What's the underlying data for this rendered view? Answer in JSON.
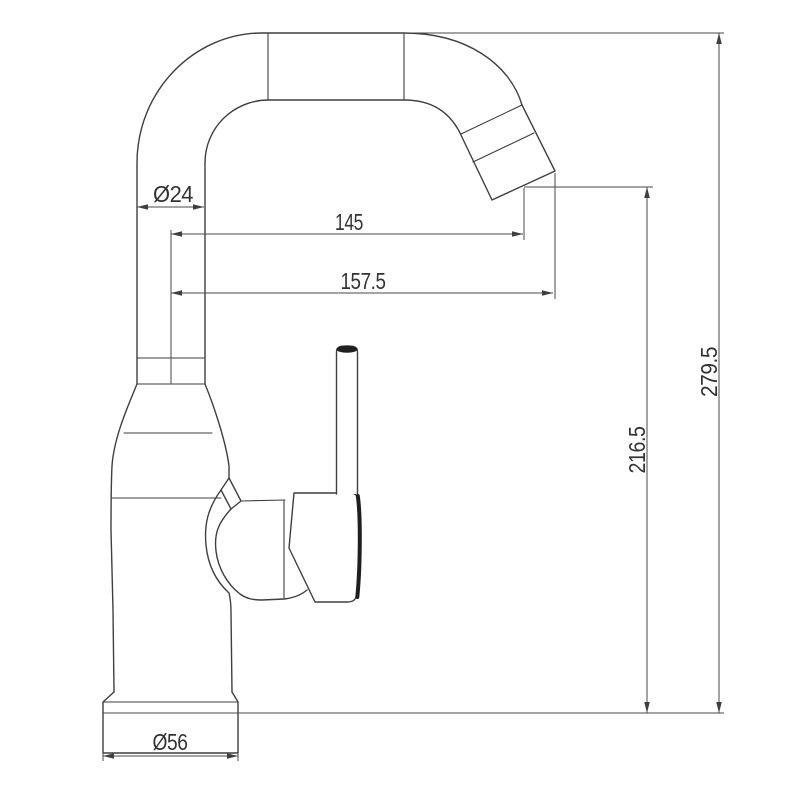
{
  "drawing": {
    "background": "#ffffff",
    "object_line_color": "#3f3f3f",
    "dimension_line_color": "#4a4a4a",
    "text_color": "#333333",
    "accent_fill_color": "#1f1f1f"
  },
  "dimensions": {
    "tube_diameter": "Ø24",
    "reach_to_outlet": "145",
    "reach_overall": "157.5",
    "outlet_height": "216.5",
    "overall_height": "279.5",
    "base_diameter": "Ø56"
  }
}
